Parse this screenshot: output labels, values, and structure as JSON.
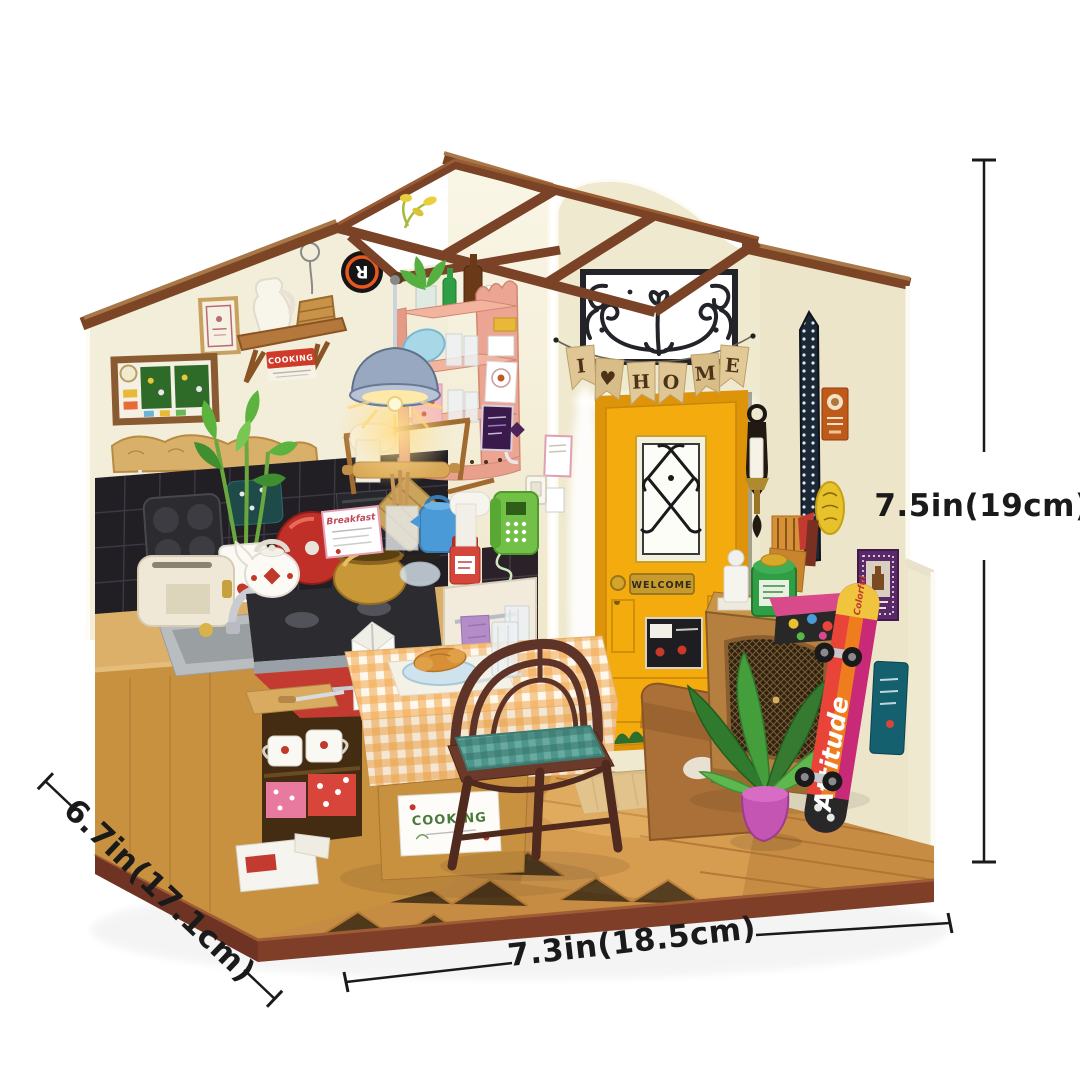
{
  "dimensions": {
    "height_label": "7.5in(19cm)",
    "depth_label": "6.7in(17.1cm)",
    "width_label": "7.3in(18.5cm)"
  },
  "scene": {
    "banner": {
      "letters": [
        "I",
        "♥",
        "H",
        "O",
        "M",
        "E"
      ]
    },
    "door": {
      "welcome_label": "WELCOME"
    },
    "skateboard": {
      "deck_text": "Attitude",
      "tip_text": "Colorful"
    },
    "wall_sign_label": "COOKING",
    "table_label": "COOKING",
    "menu_card_title": "Breakfast",
    "logo_letter": "R",
    "colors": {
      "door_yellow": "#f4ab0e",
      "wall_cream": "#f3eeda",
      "facade_cream": "#efe9cf",
      "trim_brown": "#7c4526",
      "floor_wood": "#c78c44",
      "shelf_pink": "#eba592",
      "skateboard_magenta": "#d8306a",
      "measure_ink": "#1a1a1a"
    }
  }
}
